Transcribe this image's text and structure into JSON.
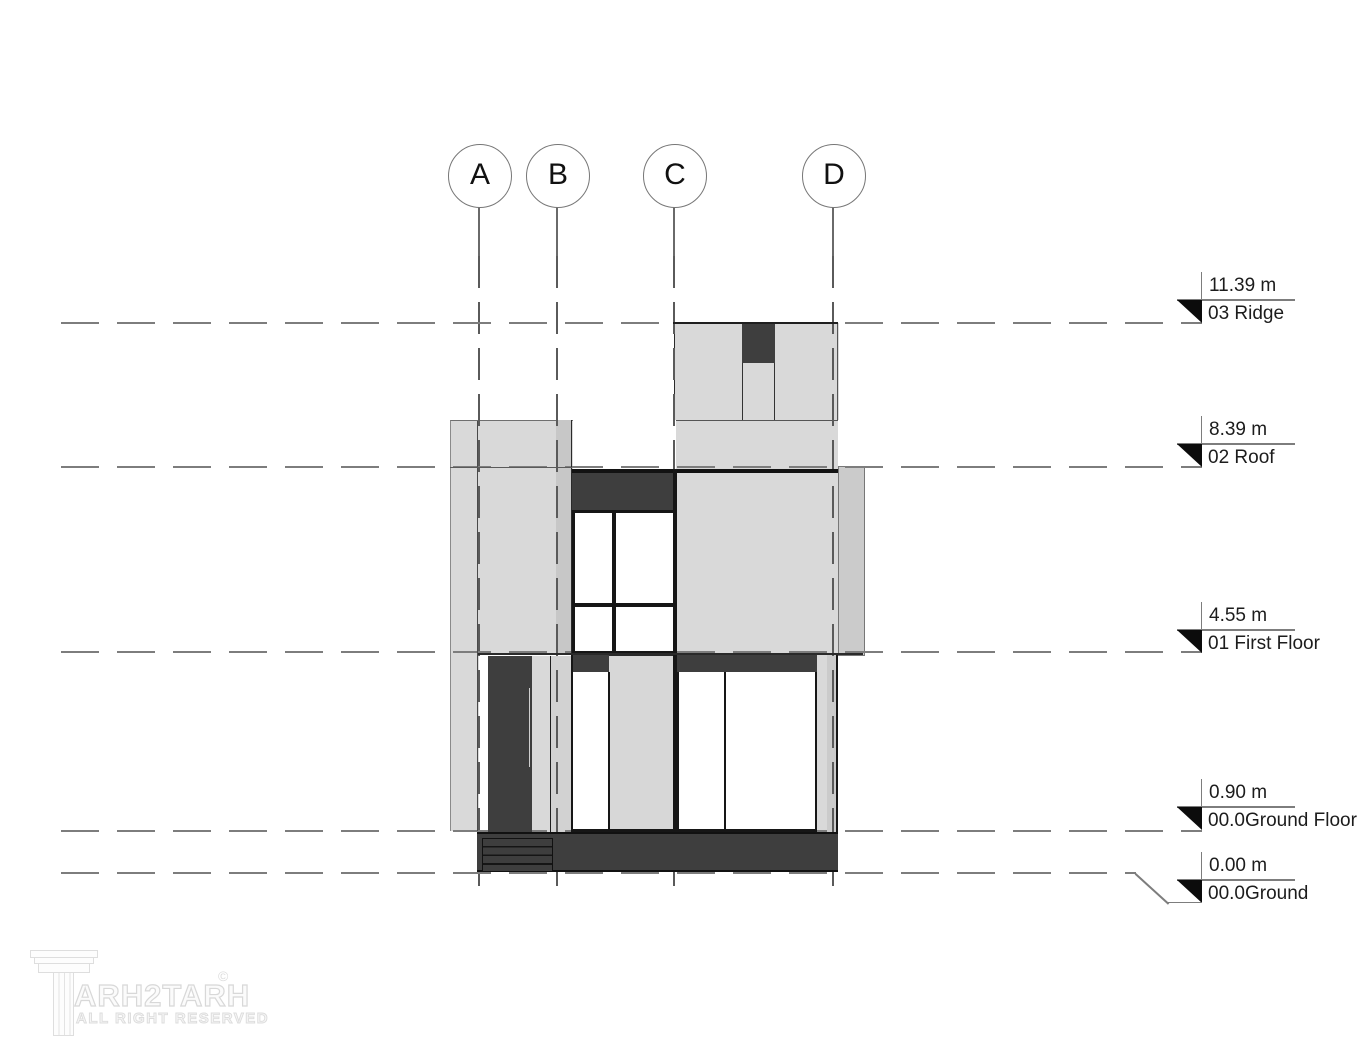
{
  "grid": {
    "bubbles": [
      {
        "label": "A",
        "x": 479
      },
      {
        "label": "B",
        "x": 557
      },
      {
        "label": "C",
        "x": 674
      },
      {
        "label": "D",
        "x": 833
      }
    ]
  },
  "levels": [
    {
      "value": "11.39 m",
      "name": "03 Ridge",
      "line_y": 323,
      "marker_y": 300,
      "jog": false
    },
    {
      "value": "8.39 m",
      "name": "02 Roof",
      "line_y": 467,
      "marker_y": 444,
      "jog": false
    },
    {
      "value": "4.55 m",
      "name": "01 First Floor",
      "line_y": 652,
      "marker_y": 630,
      "jog": false
    },
    {
      "value": "0.90 m",
      "name": "00.0Ground Floor",
      "line_y": 831,
      "marker_y": 807,
      "jog": false
    },
    {
      "value": "0.00 m",
      "name": "00.0Ground",
      "line_y": 873,
      "marker_y": 880,
      "jog": true
    }
  ],
  "watermark": {
    "brand": "ARH2TARH",
    "mark": "©",
    "subtitle": "ALL RIGHT RESERVED"
  },
  "colors": {
    "light_fill": "#d9d9d9",
    "medium_fill": "#c7c7c7",
    "dark_fill": "#3e3e3e",
    "outline": "#1a1a1a",
    "level_line": "#7d7d7d",
    "grid_line": "#5a5a5a"
  }
}
